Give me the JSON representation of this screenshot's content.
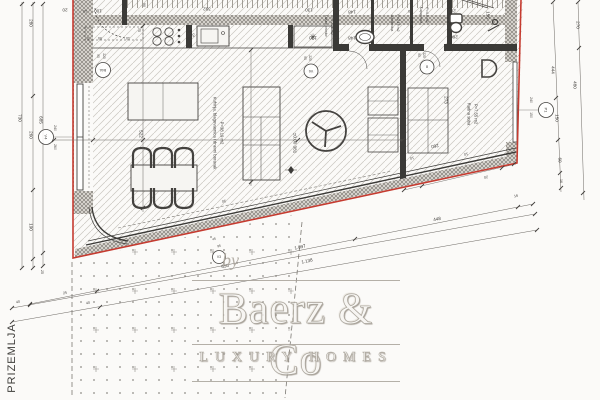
{
  "floor_label": "PRIZEMLJA",
  "watermark": {
    "by": "by",
    "name": "Baerz & Co",
    "tagline": "LUXURY HOMES"
  },
  "colors": {
    "boundary_red": "#c53b30",
    "ink": "#44423f",
    "watermark_gray": "#a8a29a"
  },
  "rooms": [
    {
      "name": "Kuhinja, blagovaonica i dnevni boravak",
      "area": "P=38.19 m2"
    },
    {
      "name": "Ulazni prostor",
      "area": "P=2.05 m2"
    },
    {
      "name": "Garderoba",
      "area": "P=2.19 m2"
    },
    {
      "name": "Kupaonica",
      "area": "P=4.0 m2"
    },
    {
      "name": "Radna soba",
      "area": "P=7.55 m2"
    }
  ],
  "level_mark": "±0.00  381",
  "markers": [
    {
      "t": "V4",
      "x": 46,
      "y": 137,
      "rad": 7.5,
      "r": 90,
      "s": 4
    },
    {
      "t": "B4A",
      "x": 103,
      "y": 70,
      "rad": 7.5,
      "r": 180,
      "s": 3.4
    },
    {
      "t": "V6",
      "x": 311,
      "y": 71,
      "rad": 7,
      "r": 180,
      "s": 3.6
    },
    {
      "t": "8",
      "x": 427,
      "y": 67,
      "rad": 7,
      "r": 180,
      "s": 4
    },
    {
      "t": "P1",
      "x": 546,
      "y": 110,
      "rad": 7.5,
      "r": 90,
      "s": 4
    },
    {
      "t": "V3",
      "x": 219,
      "y": 257,
      "rad": 6.5,
      "r": 0,
      "s": 3.4
    }
  ],
  "annotations": [
    {
      "t": "20",
      "x": 65,
      "y": 10,
      "r": 180
    },
    {
      "t": "10",
      "x": 85,
      "y": 11,
      "r": 180,
      "s": 3.8
    },
    {
      "t": "100",
      "x": 98,
      "y": 11,
      "r": 180
    },
    {
      "t": "5",
      "x": 88,
      "y": 38,
      "r": 180,
      "s": 3.6
    },
    {
      "t": "95",
      "x": 100,
      "y": 38,
      "r": 180,
      "s": 3.6
    },
    {
      "t": "10",
      "x": 128,
      "y": 38,
      "r": 180,
      "s": 3.6
    },
    {
      "t": "75",
      "x": 139,
      "y": 30,
      "r": 90,
      "s": 3.6
    },
    {
      "t": "90",
      "x": 144,
      "y": 5,
      "r": 90,
      "s": 3.6
    },
    {
      "t": "392",
      "x": 207,
      "y": 9,
      "r": 180
    },
    {
      "t": "332",
      "x": 191,
      "y": 35,
      "r": 180
    },
    {
      "t": "✳",
      "x": 313,
      "y": 37,
      "r": 0,
      "s": 9
    },
    {
      "t": "130",
      "x": 309,
      "y": 10,
      "r": 180
    },
    {
      "t": "10",
      "x": 336,
      "y": 11,
      "r": 180,
      "s": 3.6
    },
    {
      "t": "148",
      "x": 352,
      "y": 12,
      "r": 180
    },
    {
      "t": "130",
      "x": 313,
      "y": 38,
      "r": 180
    },
    {
      "t": "10",
      "x": 335,
      "y": 38,
      "r": 180,
      "s": 3.6
    },
    {
      "t": "148",
      "x": 352,
      "y": 38,
      "r": 180
    },
    {
      "t": "10",
      "x": 410,
      "y": 11,
      "r": 180,
      "s": 3.6
    },
    {
      "t": "260",
      "x": 452,
      "y": 11,
      "r": 180
    },
    {
      "t": "10",
      "x": 411,
      "y": 37,
      "r": 180,
      "s": 3.6
    },
    {
      "t": "260",
      "x": 454,
      "y": 37,
      "r": 180
    },
    {
      "t": "155",
      "x": 488,
      "y": 15,
      "r": 90
    },
    {
      "t": "10",
      "x": 496,
      "y": 47,
      "r": 180,
      "s": 3.6
    },
    {
      "t": "730",
      "x": 20,
      "y": 118,
      "r": 90
    },
    {
      "t": "280",
      "x": 31,
      "y": 23,
      "r": 90
    },
    {
      "t": "260",
      "x": 31,
      "y": 135,
      "r": 90
    },
    {
      "t": "190",
      "x": 31,
      "y": 227,
      "r": 90
    },
    {
      "t": "685",
      "x": 41,
      "y": 120,
      "r": 90
    },
    {
      "t": "25",
      "x": 42,
      "y": 272,
      "r": 90,
      "s": 3.6
    },
    {
      "t": "240",
      "x": 55,
      "y": 128,
      "r": 90,
      "s": 3.4
    },
    {
      "t": "260",
      "x": 55,
      "y": 147,
      "r": 90,
      "s": 3.4
    },
    {
      "t": "90",
      "x": 98,
      "y": 56,
      "r": 90,
      "s": 3.2
    },
    {
      "t": "220",
      "x": 104,
      "y": 56,
      "r": 90,
      "s": 3.2
    },
    {
      "t": "522",
      "x": 141,
      "y": 134,
      "r": 90
    },
    {
      "t": "Kuhinja, blagovaonica i dnevni boravak",
      "x": 215,
      "y": 133,
      "r": 90,
      "s": 4.2
    },
    {
      "t": "P=38.19 m2",
      "x": 222,
      "y": 133,
      "r": 90,
      "s": 4.2
    },
    {
      "t": "±0.00  381",
      "x": 295,
      "y": 143,
      "r": 90,
      "s": 4.6
    },
    {
      "t": "90",
      "x": 305,
      "y": 58,
      "r": 90,
      "s": 3.2
    },
    {
      "t": "220",
      "x": 310,
      "y": 58,
      "r": 90,
      "s": 3.2
    },
    {
      "t": "Ulazni prostor",
      "x": 326,
      "y": 26,
      "r": 90,
      "s": 3.5
    },
    {
      "t": "P=2.05 m2",
      "x": 332,
      "y": 26,
      "r": 90,
      "s": 3.5
    },
    {
      "t": "Garderoba",
      "x": 392,
      "y": 23,
      "r": 90,
      "s": 3.5
    },
    {
      "t": "P=2.19 m2",
      "x": 398,
      "y": 23,
      "r": 90,
      "s": 3.5
    },
    {
      "t": "Kupaonica",
      "x": 421,
      "y": 15,
      "r": 90,
      "s": 3.5
    },
    {
      "t": "P=4.0 m2",
      "x": 427,
      "y": 15,
      "r": 90,
      "s": 3.5
    },
    {
      "t": "90",
      "x": 419,
      "y": 55,
      "r": 90,
      "s": 3.2
    },
    {
      "t": "220",
      "x": 424,
      "y": 55,
      "r": 90,
      "s": 3.2
    },
    {
      "t": "273",
      "x": 446,
      "y": 100,
      "r": 90
    },
    {
      "t": "Radna soba",
      "x": 469,
      "y": 114,
      "r": 90,
      "s": 4.2
    },
    {
      "t": "P=7.55 m2",
      "x": 476,
      "y": 114,
      "r": 90,
      "s": 4.2
    },
    {
      "t": "444",
      "x": 553,
      "y": 70,
      "r": 90
    },
    {
      "t": "150",
      "x": 557,
      "y": 118,
      "r": 90
    },
    {
      "t": "60",
      "x": 560,
      "y": 160,
      "r": 90
    },
    {
      "t": "16",
      "x": 561,
      "y": 181,
      "r": 90,
      "s": 3.6
    },
    {
      "t": "270",
      "x": 578,
      "y": 25,
      "r": 90
    },
    {
      "t": "480",
      "x": 575,
      "y": 85,
      "r": 90
    },
    {
      "t": "240",
      "x": 531,
      "y": 100,
      "r": 90,
      "s": 3.4
    },
    {
      "t": "150",
      "x": 531,
      "y": 115,
      "r": 90,
      "s": 3.4
    },
    {
      "t": "650",
      "x": 225,
      "y": 266,
      "r": -12
    },
    {
      "t": "448",
      "x": 437,
      "y": 219,
      "r": -12
    },
    {
      "t": "1.097",
      "x": 300,
      "y": 247,
      "r": -12
    },
    {
      "t": "1.138",
      "x": 307,
      "y": 261,
      "r": -12
    },
    {
      "t": "25",
      "x": 65,
      "y": 293,
      "r": -12,
      "s": 3.6
    },
    {
      "t": "40",
      "x": 18,
      "y": 302,
      "r": -12,
      "s": 3.6
    },
    {
      "t": "40",
      "x": 88,
      "y": 303,
      "r": -12,
      "s": 3.6
    },
    {
      "t": "16",
      "x": 516,
      "y": 196,
      "r": -12,
      "s": 3.6
    },
    {
      "t": "30",
      "x": 224,
      "y": 201,
      "r": 168,
      "s": 3.6
    },
    {
      "t": "10",
      "x": 412,
      "y": 158,
      "r": 168,
      "s": 3.6
    },
    {
      "t": "260",
      "x": 435,
      "y": 146,
      "r": 168
    },
    {
      "t": "10",
      "x": 466,
      "y": 154,
      "r": 168,
      "s": 3.6
    },
    {
      "t": "20",
      "x": 486,
      "y": 177,
      "r": 168,
      "s": 3.6
    },
    {
      "t": "45",
      "x": 214,
      "y": 239,
      "r": -12,
      "s": 3.2
    },
    {
      "t": "95",
      "x": 219,
      "y": 246,
      "r": -12,
      "s": 3.2
    }
  ]
}
